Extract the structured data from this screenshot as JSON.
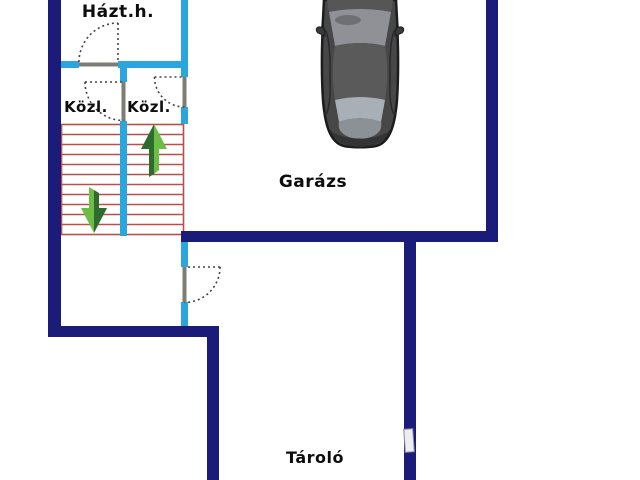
{
  "floorplan": {
    "rooms": [
      {
        "label": "Házt.h."
      },
      {
        "label": "Közl."
      },
      {
        "label": "Közl."
      },
      {
        "label": "Garázs"
      },
      {
        "label": "Tároló"
      }
    ],
    "colors": {
      "background": "#ffffff",
      "exterior_wall": "#1b1b7a",
      "interior_wall": "#2ba5de",
      "stair_line": "#b5504a",
      "arrow_light_green": "#6cbd45",
      "arrow_dark_green": "#2e6b2e",
      "door_leaf": "#7d7d73",
      "car_body": "#474747"
    },
    "icons": {
      "car": "car-top-view-icon",
      "up_arrow": "stairs-up-arrow-icon",
      "down_arrow": "stairs-down-arrow-icon",
      "door": "door-swing-arc-icon",
      "window": "window-marker"
    }
  }
}
